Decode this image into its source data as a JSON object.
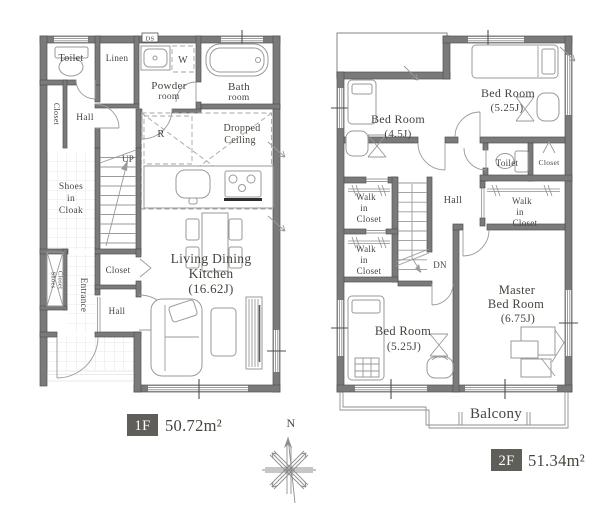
{
  "floor1": {
    "badge": "1F",
    "area": "50.72m²",
    "labels": {
      "toilet": "Toilet",
      "linen": "Linen",
      "powder1": "Powder",
      "powder2": "room",
      "bath1": "Bath",
      "bath2": "room",
      "ds": "DS",
      "washer": "W",
      "fridge": "R",
      "closet_upper": "Closet",
      "hall_upper": "Hall",
      "cloak1": "Shoes",
      "cloak2": "in",
      "cloak3": "Cloak",
      "up": "UP",
      "shoes_closet1": "Shoes",
      "shoes_closet2": "Closet",
      "entrance": "Entrance",
      "closet_mid": "Closet",
      "hall_lower": "Hall",
      "dropped1": "Dropped",
      "dropped2": "Ceiling",
      "ldk1": "Living Dining",
      "ldk2": "Kitchen",
      "ldk3": "(16.62J)"
    }
  },
  "floor2": {
    "badge": "2F",
    "area": "51.34m²",
    "labels": {
      "bed45_1": "Bed Room",
      "bed45_2": "(4.5J)",
      "bed525a_1": "Bed Room",
      "bed525a_2": "(5.25J)",
      "toilet": "Toilet",
      "closet": "Closet",
      "wic_a1": "Walk",
      "wic_a2": "in",
      "wic_a3": "Closet",
      "wic_b1": "Walk",
      "wic_b2": "in",
      "wic_b3": "Closet",
      "wic_c1": "Walk",
      "wic_c2": "in",
      "wic_c3": "Closet",
      "hall": "Hall",
      "dn": "DN",
      "bed525b_1": "Bed Room",
      "bed525b_2": "(5.25J)",
      "master1": "Master",
      "master2": "Bed Room",
      "master3": "(6.75J)",
      "balcony": "Balcony"
    }
  },
  "compass": {
    "north": "N"
  },
  "colors": {
    "wall": "#7a7a7a",
    "text": "#46443d",
    "badge_bg": "#5f5e59",
    "badge_text": "#ffffff"
  }
}
